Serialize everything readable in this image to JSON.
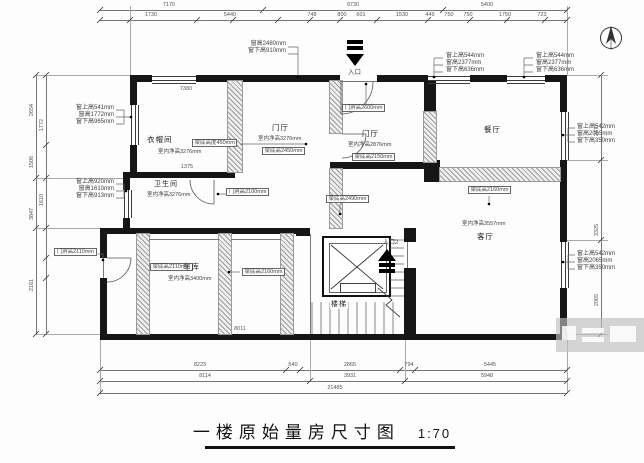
{
  "title": {
    "main": "一楼原始量房尺寸图",
    "scale": "1:70"
  },
  "entrances": {
    "main": "入口",
    "secondary": "入口2"
  },
  "rooms": {
    "cloakroom": {
      "name": "衣帽间",
      "beam_note": "梁底高度450mm",
      "clear_height": "室内净高3276mm"
    },
    "foyer1": {
      "name": "门厅",
      "clear_height": "室内净高3276mm",
      "beam": "梁底高2450mm"
    },
    "foyer2": {
      "name": "门厅",
      "clear_height": "室内净高2876mm",
      "beam": "梁底高2150mm",
      "door": "门洞高2600mm"
    },
    "dining": {
      "name": "餐厅"
    },
    "living": {
      "name": "客厅",
      "clear_height": "室内净高3557mm",
      "beam": "梁底高2160mm"
    },
    "bathroom": {
      "name": "卫生间",
      "clear_height": "室内净高3276mm",
      "door": "门洞高2100mm"
    },
    "garage": {
      "name": "车库",
      "clear_height": "室内净高3400mm",
      "beam_left": "梁底高2110mm",
      "beam_right": "梁底高2160mm",
      "door": "门洞高2110mm"
    },
    "stairs": {
      "name": "楼梯"
    },
    "mid_beam": "梁底高2490mm"
  },
  "window_annotations": {
    "top_left": [
      "窗高2480mm",
      "窗下高910mm"
    ],
    "top_right_1": [
      "窗上高544mm",
      "窗高2377mm",
      "窗下高636mm"
    ],
    "top_right_2": [
      "窗上高544mm",
      "窗高2377mm",
      "窗下高636mm"
    ],
    "right_upper": [
      "窗上高542mm",
      "窗高2065mm",
      "窗下高350mm"
    ],
    "right_lower": [
      "窗上高542mm",
      "窗高2065mm",
      "窗下高350mm"
    ],
    "left_upper": [
      "窗上高541mm",
      "窗高1772mm",
      "窗下高965mm"
    ],
    "left_lower": [
      "窗上高920mm",
      "窗高1610mm",
      "窗下高913mm"
    ]
  },
  "dimensions": {
    "top_row1": [
      "7170",
      "9730",
      "5400"
    ],
    "top_row2": [
      "1730",
      "5440",
      "748",
      "800",
      "601",
      "1530",
      "449",
      "750",
      "750",
      "1750",
      "723"
    ],
    "bottom_row1": [
      "8223",
      "540",
      "2865",
      "794",
      "5445"
    ],
    "bottom_row2": [
      "8114",
      "3931",
      "5948"
    ],
    "bottom_total": "21485",
    "left_col": [
      "2654",
      "1506",
      "3847",
      "2161"
    ],
    "left_inner": [
      "1772",
      "1610"
    ],
    "right_col": [
      "2377",
      "3325",
      "2065"
    ],
    "inner": [
      "7380",
      "1375",
      "8011"
    ]
  }
}
